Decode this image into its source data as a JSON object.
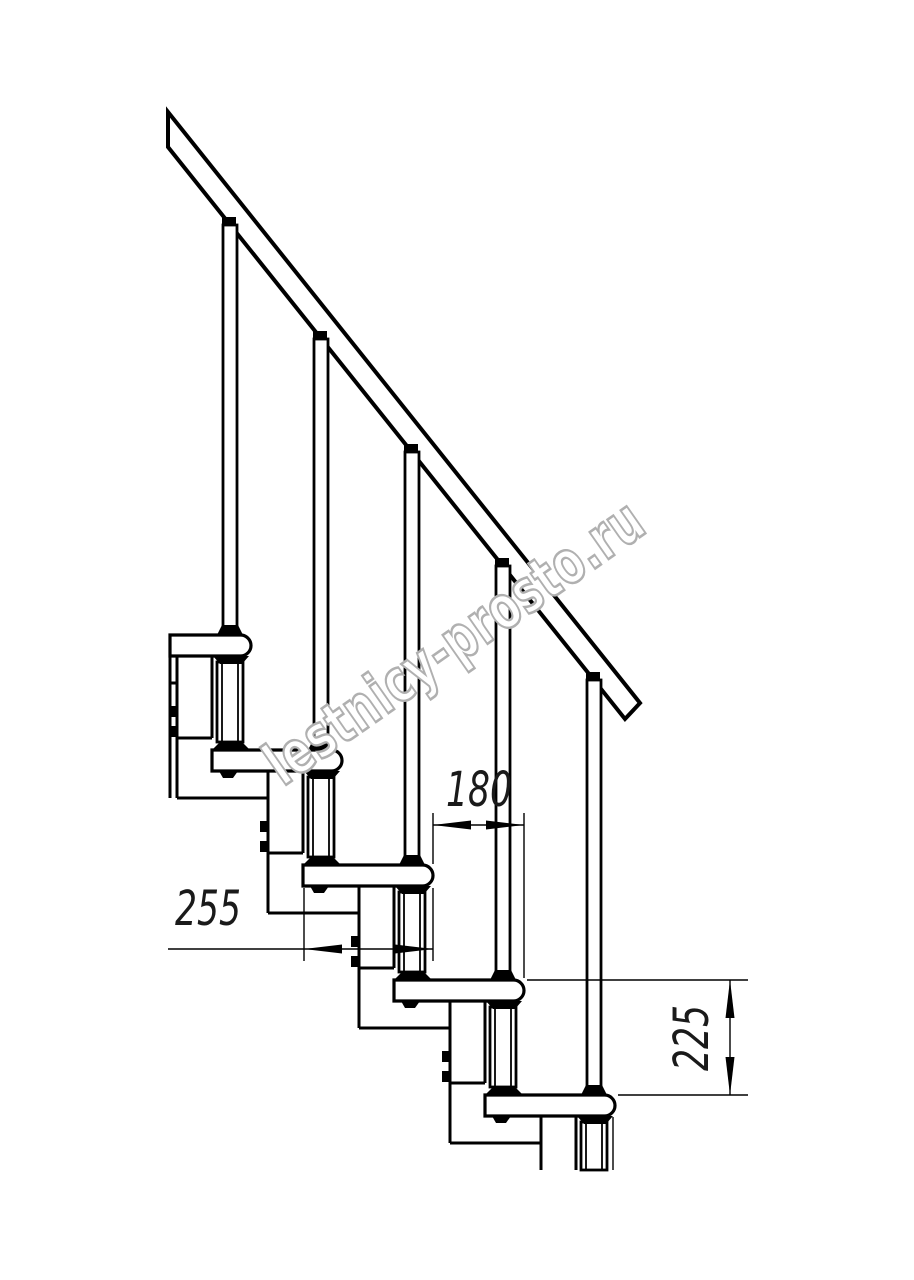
{
  "drawing": {
    "background": "#ffffff",
    "line_color": "#000000",
    "treads_visible": 5,
    "balusters_visible": 5
  },
  "dimensions": {
    "tread_run": {
      "label": "180"
    },
    "tread_depth": {
      "label": "255"
    },
    "riser_height": {
      "label": "225"
    }
  },
  "watermark": {
    "text": "lestnicy-prosto.ru",
    "color": "#b0b0b0"
  }
}
